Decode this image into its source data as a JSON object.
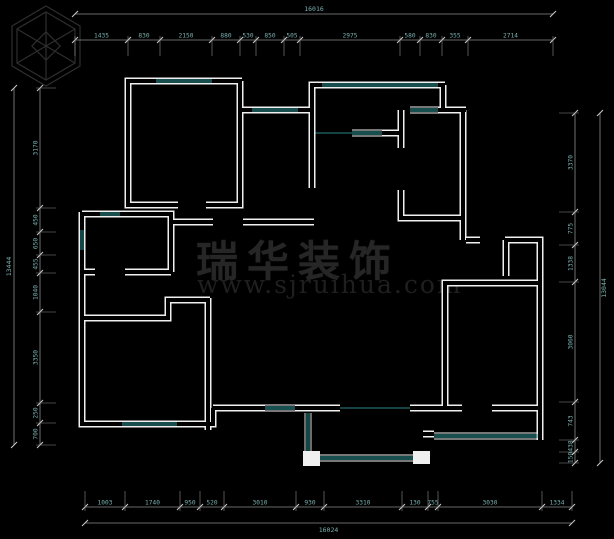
{
  "watermark": {
    "brand": "瑞华装饰",
    "url": "www.sjruihua.com"
  },
  "colors": {
    "bg": "#000000",
    "wall": "#f0f0f0",
    "glass": "#2f9b9b",
    "dimline": "#8c8c8c",
    "tick": "#cfcfcf",
    "dimtext": "#79b0b0",
    "thin": "#2a8585",
    "watermark": "#262626"
  },
  "floorplan": {
    "walls": [
      [
        [
          242,
          81
        ],
        [
          128,
          81
        ],
        [
          128,
          205
        ],
        [
          178,
          205
        ]
      ],
      [
        [
          206,
          205
        ],
        [
          240,
          205
        ],
        [
          240,
          81
        ]
      ],
      [
        [
          240,
          110
        ],
        [
          312,
          110
        ]
      ],
      [
        [
          445,
          85
        ],
        [
          312,
          85
        ],
        [
          312,
          188
        ]
      ],
      [
        [
          243,
          222
        ],
        [
          314,
          222
        ]
      ],
      [
        [
          171,
          222
        ],
        [
          213,
          222
        ]
      ],
      [
        [
          443,
          85
        ],
        [
          443,
          110
        ]
      ],
      [
        [
          438,
          110
        ],
        [
          466,
          110
        ]
      ],
      [
        [
          401,
          110
        ],
        [
          401,
          148
        ]
      ],
      [
        [
          401,
          190
        ],
        [
          401,
          218
        ],
        [
          463,
          218
        ]
      ],
      [
        [
          463,
          110
        ],
        [
          463,
          240
        ]
      ],
      [
        [
          382,
          133
        ],
        [
          403,
          133
        ]
      ],
      [
        [
          466,
          240
        ],
        [
          480,
          240
        ]
      ],
      [
        [
          505,
          240
        ],
        [
          540,
          240
        ],
        [
          540,
          440
        ]
      ],
      [
        [
          506,
          240
        ],
        [
          506,
          276
        ]
      ],
      [
        [
          540,
          283
        ],
        [
          445,
          283
        ],
        [
          445,
          408
        ]
      ],
      [
        [
          410,
          408
        ],
        [
          462,
          408
        ]
      ],
      [
        [
          492,
          408
        ],
        [
          540,
          408
        ]
      ],
      [
        [
          423,
          434
        ],
        [
          434,
          434
        ]
      ],
      [
        [
          213,
          408
        ],
        [
          265,
          408
        ]
      ],
      [
        [
          295,
          408
        ],
        [
          340,
          408
        ]
      ],
      [
        [
          210,
          300
        ],
        [
          168,
          300
        ],
        [
          168,
          318
        ],
        [
          82,
          318
        ]
      ],
      [
        [
          208,
          298
        ],
        [
          208,
          430
        ]
      ],
      [
        [
          82,
          212
        ],
        [
          82,
          424
        ],
        [
          213,
          424
        ],
        [
          213,
          408
        ]
      ],
      [
        [
          82,
          214
        ],
        [
          171,
          214
        ],
        [
          171,
          272
        ]
      ],
      [
        [
          82,
          272
        ],
        [
          95,
          272
        ]
      ],
      [
        [
          125,
          272
        ],
        [
          171,
          272
        ]
      ]
    ],
    "windows": [
      [
        156,
        81,
        212,
        81
      ],
      [
        252,
        110,
        298,
        110
      ],
      [
        322,
        85,
        438,
        85
      ],
      [
        410,
        110,
        438,
        110
      ],
      [
        352,
        133,
        382,
        133
      ],
      [
        82,
        230,
        82,
        250
      ],
      [
        100,
        214,
        120,
        214
      ],
      [
        122,
        424,
        177,
        424
      ],
      [
        265,
        408,
        295,
        408
      ],
      [
        434,
        436,
        538,
        436
      ],
      [
        308,
        413,
        308,
        451
      ],
      [
        320,
        458,
        413,
        458
      ]
    ],
    "thin_lines": [
      [
        340,
        408,
        410,
        408
      ],
      [
        312,
        133,
        352,
        133
      ]
    ],
    "columns": [
      [
        303,
        451,
        17,
        15
      ],
      [
        413,
        451,
        17,
        13
      ]
    ],
    "chains": [
      {
        "side": "top",
        "line": 40,
        "bounds": [
          75,
          128,
          160,
          212,
          240,
          256,
          284,
          300,
          400,
          420,
          442,
          468,
          553
        ],
        "labels": [
          "1435",
          "830",
          "2150",
          "880",
          "530",
          "850",
          "505",
          "2975",
          "580",
          "830",
          "355",
          "2714"
        ]
      },
      {
        "side": "bottom",
        "line": 507,
        "bounds": [
          85,
          125,
          180,
          200,
          224,
          296,
          324,
          402,
          428,
          438,
          542,
          572
        ],
        "labels": [
          "1003",
          "1740",
          "950",
          "520",
          "3010",
          "930",
          "3310",
          "130",
          "755",
          "3030",
          "1334"
        ]
      },
      {
        "side": "left",
        "line": 40,
        "bounds": [
          88,
          208,
          232,
          255,
          273,
          312,
          403,
          423,
          445
        ],
        "labels": [
          "3170",
          "450",
          "650",
          "455",
          "1040",
          "3350",
          "250",
          "700"
        ]
      },
      {
        "side": "right",
        "line": 575,
        "bounds": [
          113,
          212,
          245,
          282,
          402,
          440,
          452,
          463
        ],
        "labels": [
          "3370",
          "775",
          "1338",
          "3060",
          "743",
          "438",
          "150"
        ]
      }
    ],
    "overalls": [
      {
        "side": "top",
        "line": 14,
        "start": 75,
        "end": 553,
        "label": "16016"
      },
      {
        "side": "bottom",
        "line": 523,
        "start": 85,
        "end": 572,
        "label": "16024"
      },
      {
        "side": "left",
        "line": 14,
        "start": 88,
        "end": 445,
        "label": "13444"
      },
      {
        "side": "right",
        "line": 600,
        "start": 113,
        "end": 463,
        "label": "13044"
      }
    ]
  }
}
